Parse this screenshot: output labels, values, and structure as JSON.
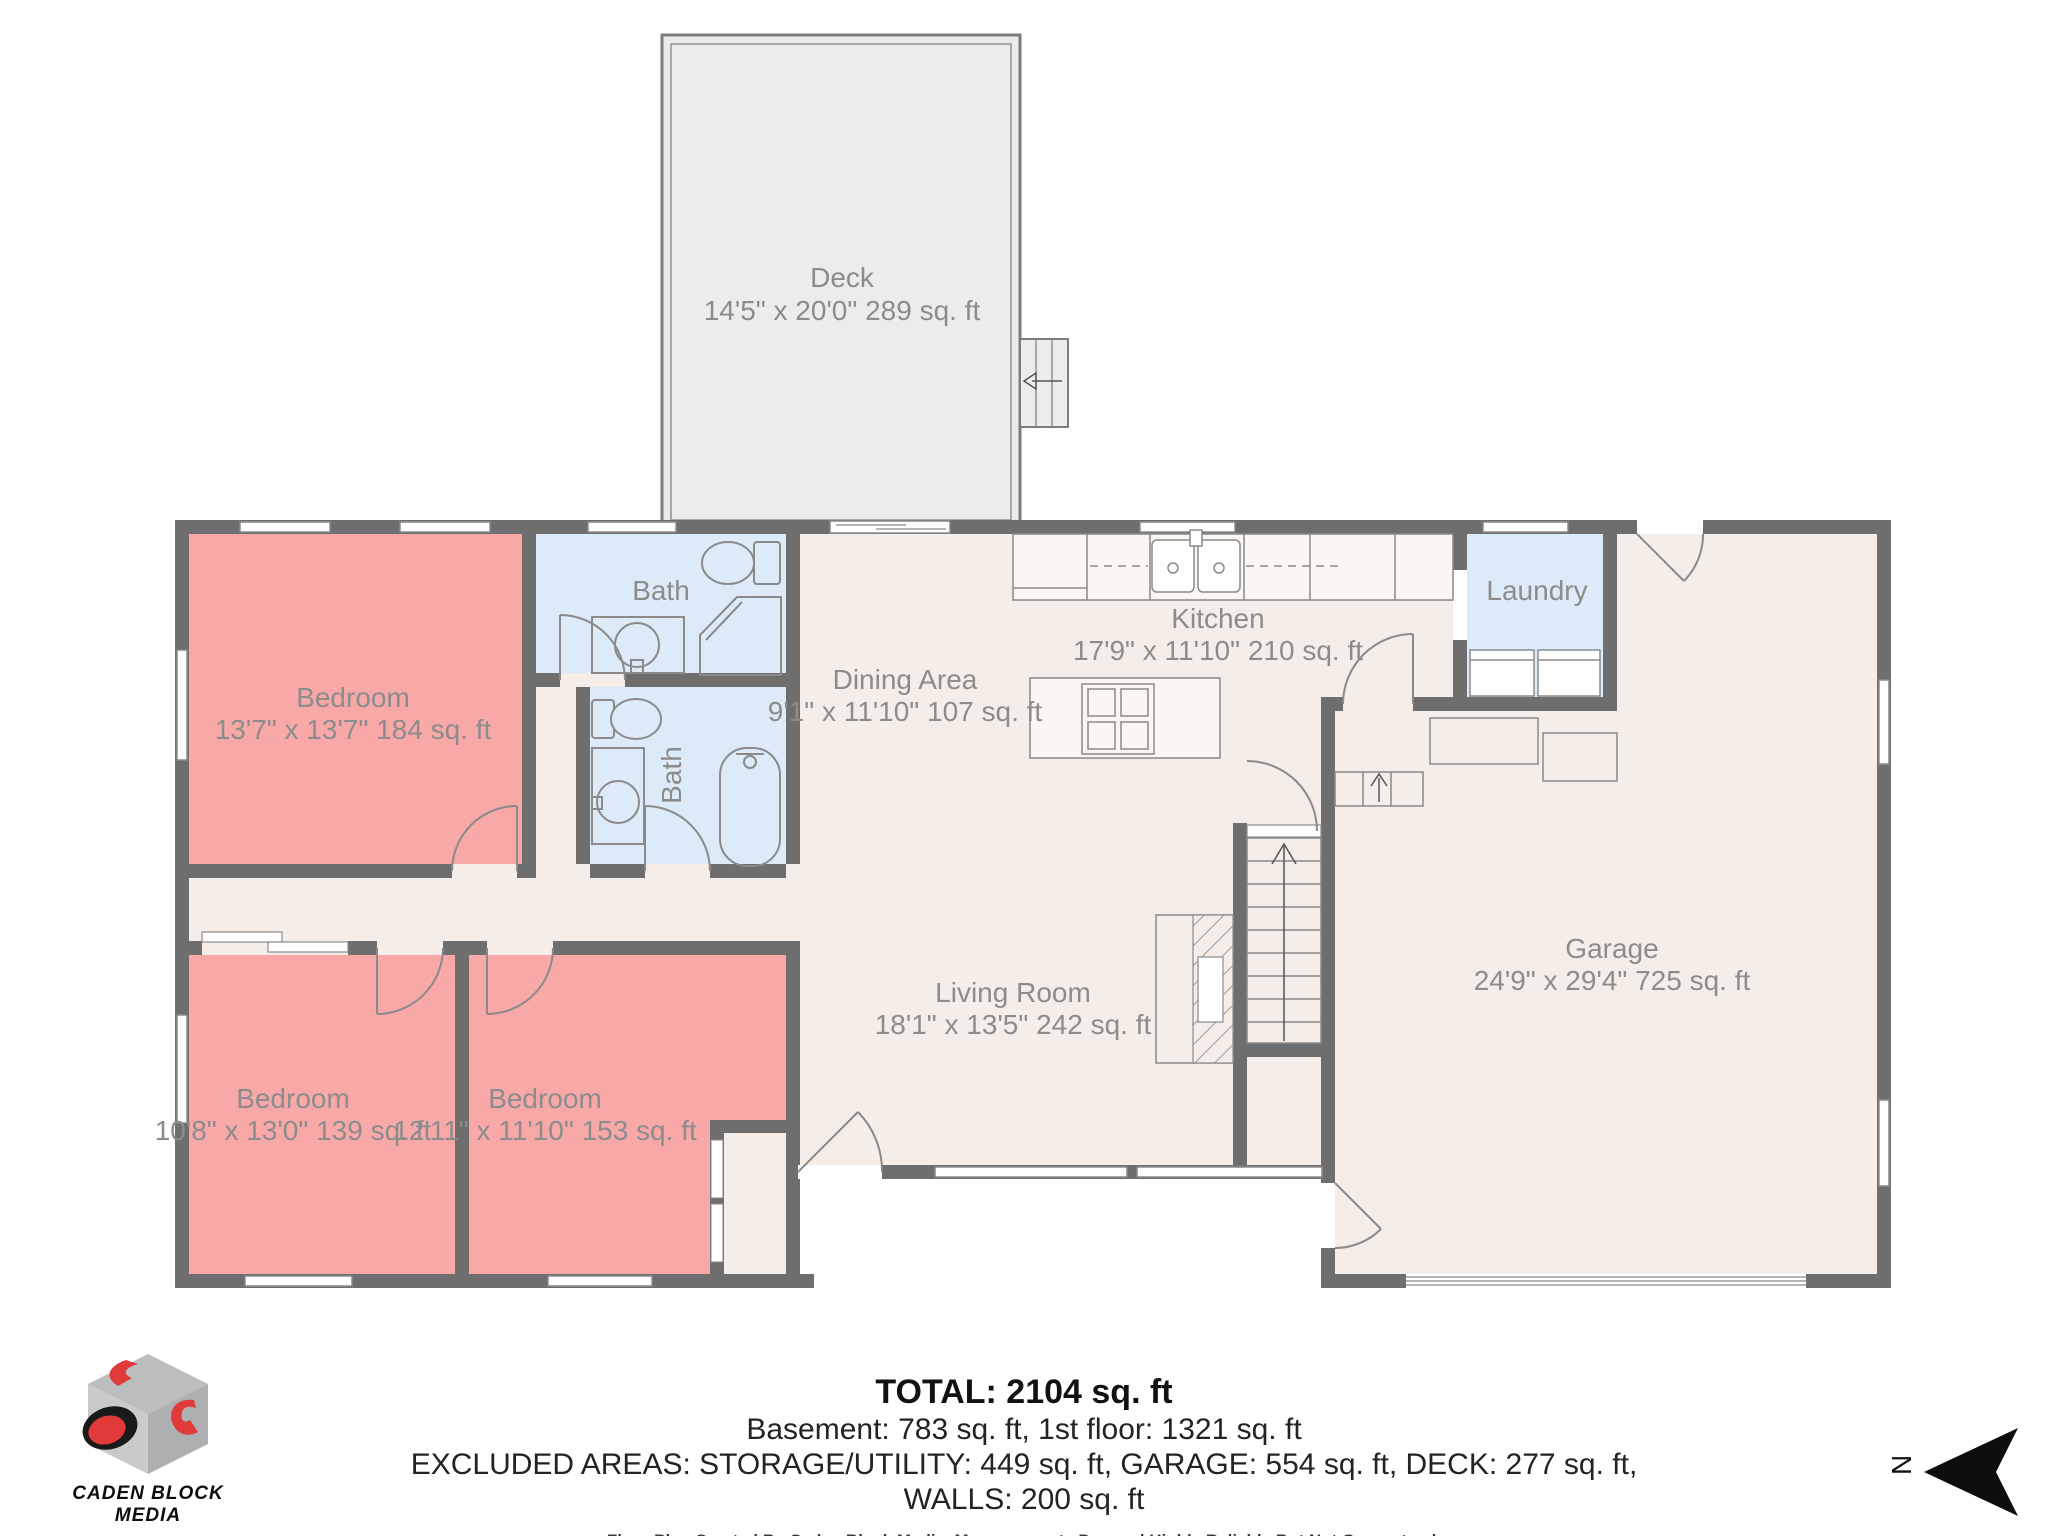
{
  "colors": {
    "wall": "#6e6e6e",
    "bedroom_fill": "#f9a8a8",
    "bath_fill": "#dcebf7",
    "floor_fill": "#f5ede7",
    "deck_fill": "#ececec",
    "line": "#8a8a8a",
    "label_text": "#8c8c8c",
    "logo_red": "#e03a3a"
  },
  "rooms": {
    "deck": {
      "name": "Deck",
      "dims": "14'5\" x 20'0\" 289 sq. ft"
    },
    "bedroom_top": {
      "name": "Bedroom",
      "dims": "13'7\" x 13'7\" 184 sq. ft"
    },
    "bath_upper": {
      "name": "Bath"
    },
    "bath_lower": {
      "name": "Bath"
    },
    "dining": {
      "name": "Dining Area",
      "dims": "9'1\" x 11'10\" 107 sq. ft"
    },
    "kitchen": {
      "name": "Kitchen",
      "dims": "17'9\" x 11'10\" 210 sq. ft"
    },
    "laundry": {
      "name": "Laundry"
    },
    "living": {
      "name": "Living Room",
      "dims": "18'1\" x 13'5\" 242 sq. ft"
    },
    "garage": {
      "name": "Garage",
      "dims": "24'9\" x 29'4\" 725 sq. ft"
    },
    "bedroom_left": {
      "name": "Bedroom",
      "dims": "10'8\" x 13'0\" 139 sq. ft"
    },
    "bedroom_mid": {
      "name": "Bedroom",
      "dims": "12'11\" x 11'10\" 153 sq. ft"
    }
  },
  "summary": {
    "total": "TOTAL: 2104 sq. ft",
    "floors": "Basement: 783 sq. ft, 1st floor: 1321 sq. ft",
    "excluded": "EXCLUDED AREAS: STORAGE/UTILITY: 449 sq. ft, GARAGE: 554 sq. ft, DECK: 277 sq. ft,",
    "walls": "WALLS: 200 sq. ft",
    "disclaimer": "Floor Plan Created By Caden Block Media. Measurements Deemed Highly Reliable But Not Guaranteed."
  },
  "branding": {
    "logo_line1": "CADEN BLOCK",
    "logo_line2": "MEDIA"
  },
  "compass": {
    "north_letter": "N"
  }
}
